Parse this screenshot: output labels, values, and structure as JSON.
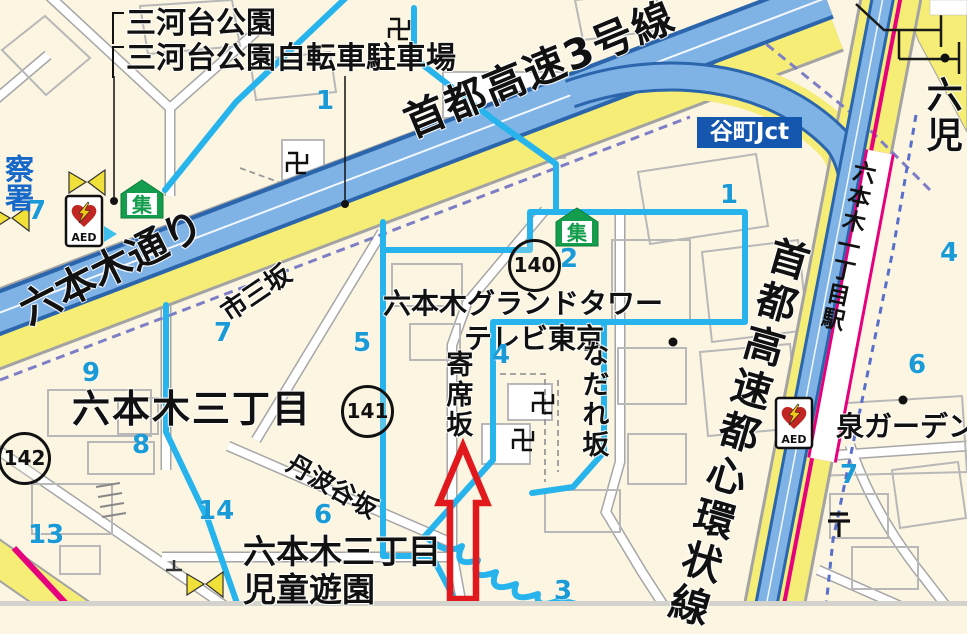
{
  "map": {
    "labels": {
      "mikawadai_park": "三河台公園",
      "mikawadai_bike_parking": "三河台公園自転車駐車場",
      "shuto_route3": "首都高速3号線",
      "tanimachi_jct": "谷町Jct",
      "roppongi_dori": "六本木通り",
      "ichimi_zaka": "市三坂",
      "roppongi_grand_tower": "六本木グランドタワー",
      "tv_tokyo": "テレビ東京",
      "nadare_zaka": "なだれ坂",
      "yose_zaka": "寄席坂",
      "roppongi_3chome": "六本木三丁目",
      "tanbadani_zaka": "丹波谷坂",
      "roppongi_3chome_south": "六本木三丁目",
      "jido_yuen": "児童遊園",
      "izumi_garden": "泉ガーデン",
      "shuto_kanjo_line": "首都高速都心環状線",
      "roppongi_itchome_station": "六本木一丁目駅",
      "partial_right_edge": "六児",
      "partial_police_station": "察署"
    },
    "circled_numbers": [
      "140",
      "141",
      "142"
    ],
    "lot_numbers": [
      "1",
      "7",
      "1",
      "2",
      "7",
      "5",
      "4",
      "4",
      "6",
      "9",
      "8",
      "13",
      "14",
      "6",
      "3",
      "7"
    ],
    "icons": {
      "aed_label": "AED",
      "assembly_label": "集",
      "temple_manji_glyph": "卍",
      "post_office_glyph": "〒"
    },
    "colors": {
      "background": "#fbf5e1",
      "boundary_blue": "#27b4ec",
      "expressway_fill": "#7fb2e5",
      "expressway_casing": "#2b66ad",
      "road_yellow": "#f5ed76",
      "railway_magenta": "#e6007e",
      "jct_box_blue": "#1556ae",
      "lot_number_blue": "#1a9bd7",
      "arrow_red": "#e2191c",
      "assembly_green": "#139d4c",
      "aed_heart_red": "#c22623"
    }
  }
}
